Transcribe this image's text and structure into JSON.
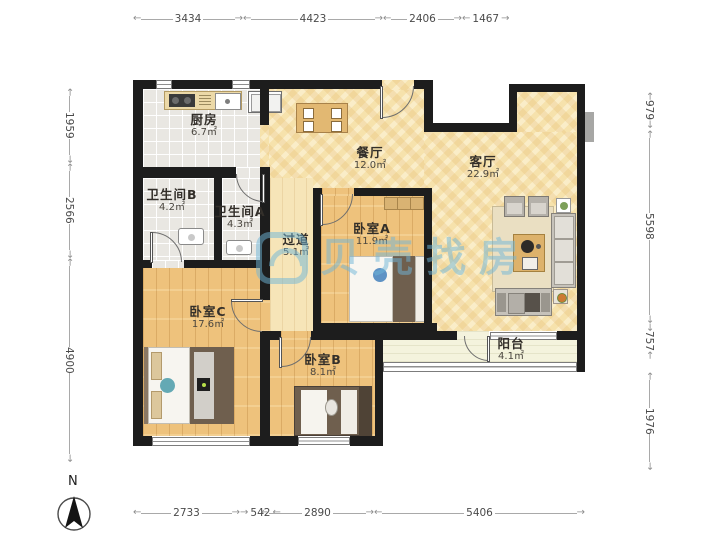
{
  "watermark": {
    "text": "贝壳找房"
  },
  "compass": {
    "label": "N"
  },
  "rooms": {
    "kitchen": {
      "name": "厨房",
      "area": "6.7㎡"
    },
    "dining": {
      "name": "餐厅",
      "area": "12.0㎡"
    },
    "living": {
      "name": "客厅",
      "area": "22.9㎡"
    },
    "bathroom_b": {
      "name": "卫生间B",
      "area": "4.2㎡"
    },
    "bathroom_a": {
      "name": "卫生间A",
      "area": "4.3㎡"
    },
    "hallway": {
      "name": "过道",
      "area": "5.1㎡"
    },
    "bedroom_a": {
      "name": "卧室A",
      "area": "11.9㎡"
    },
    "bedroom_b": {
      "name": "卧室B",
      "area": "8.1㎡"
    },
    "bedroom_c": {
      "name": "卧室C",
      "area": "17.6㎡"
    },
    "balcony": {
      "name": "阳台",
      "area": "4.1㎡"
    }
  },
  "dimensions": {
    "top": [
      "3434",
      "4423",
      "2406",
      "1467"
    ],
    "bottom": [
      "2733",
      "542",
      "2890",
      "5406"
    ],
    "left": [
      "1959",
      "2566",
      "4900"
    ],
    "right": [
      "979",
      "5598",
      "757",
      "1976"
    ]
  },
  "colors": {
    "wall": "#1d1d1d",
    "bedroom_wood": "#eec27c",
    "living_parquet": "#f6e2ac",
    "tile": "#e9e7e2",
    "balcony_floor": "#f4f3dd",
    "watermark_blue": "#6fb6d9"
  }
}
